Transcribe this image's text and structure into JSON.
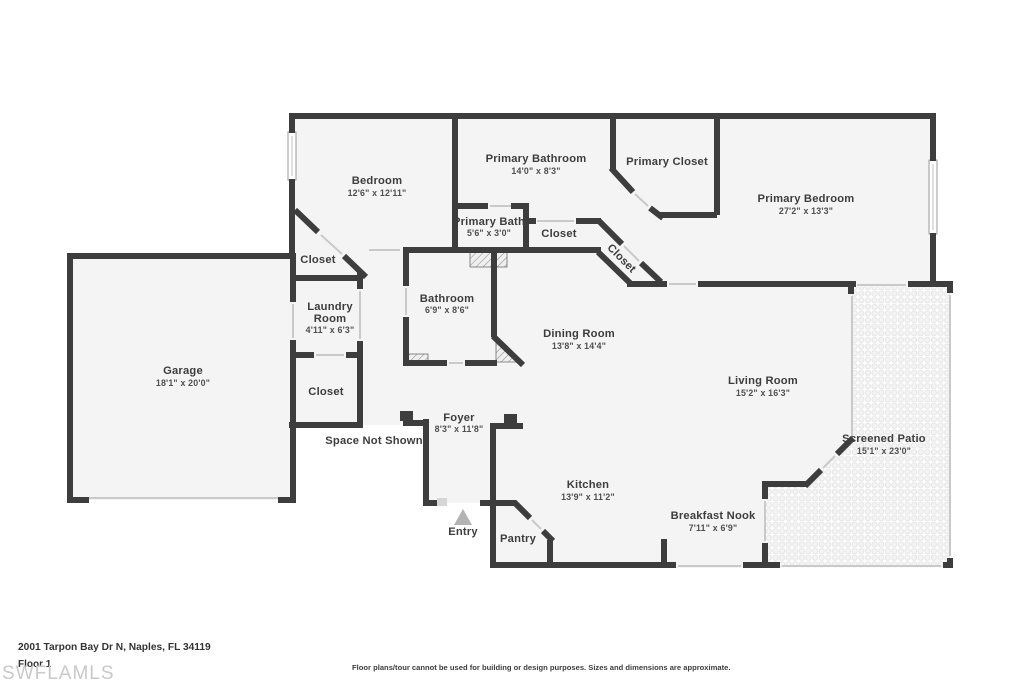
{
  "page": {
    "address": "2001 Tarpon Bay Dr N, Naples, FL 34119",
    "floor_label": "Floor 1",
    "watermark": "SWFLAMLS",
    "disclaimer": "Floor plans/tour cannot be used for building or design purposes. Sizes and dimensions are approximate."
  },
  "colors": {
    "wall": "#3d3d3d",
    "room_fill": "#f4f4f4",
    "background": "#ffffff",
    "label_text": "#3d3d3d",
    "dims_text": "#4f4f4f",
    "door_line": "#c9c9c9",
    "entry_arrow": "#b3b3b3",
    "watermark_text": "#c9c9c9",
    "patio_dot": "#e2e2e2"
  },
  "rooms": {
    "bedroom": {
      "name": "Bedroom",
      "dims": "12'6\" x 12'11\""
    },
    "primary_bathroom": {
      "name": "Primary Bathroom",
      "dims": "14'0\" x 8'3\""
    },
    "primary_closet": {
      "name": "Primary Closet"
    },
    "primary_bedroom": {
      "name": "Primary Bedroom",
      "dims": "27'2\" x 13'3\""
    },
    "primary_bath": {
      "name": "Primary Bath",
      "dims": "5'6\" x 3'0\""
    },
    "hall_closet": {
      "name": "Closet"
    },
    "hall_closet_diag": {
      "name": "Closet"
    },
    "bedroom_closet": {
      "name": "Closet"
    },
    "laundry_room": {
      "name_line1": "Laundry",
      "name_line2": "Room",
      "dims": "4'11\" x 6'3\""
    },
    "bathroom": {
      "name": "Bathroom",
      "dims": "6'9\" x 8'6\""
    },
    "dining_room": {
      "name": "Dining Room",
      "dims": "13'8\" x 14'4\""
    },
    "garage": {
      "name": "Garage",
      "dims": "18'1\" x 20'0\""
    },
    "lower_closet": {
      "name": "Closet"
    },
    "foyer": {
      "name": "Foyer",
      "dims": "8'3\" x 11'8\""
    },
    "living_room": {
      "name": "Living Room",
      "dims": "15'2\" x 16'3\""
    },
    "screened_patio": {
      "name": "Screened Patio",
      "dims": "15'1\" x 23'0\""
    },
    "kitchen": {
      "name": "Kitchen",
      "dims": "13'9\" x 11'2\""
    },
    "pantry": {
      "name": "Pantry"
    },
    "breakfast_nook": {
      "name": "Breakfast Nook",
      "dims": "7'11\" x 6'9\""
    }
  },
  "labels": {
    "entry": "Entry",
    "space_not_shown": "Space Not Shown"
  }
}
